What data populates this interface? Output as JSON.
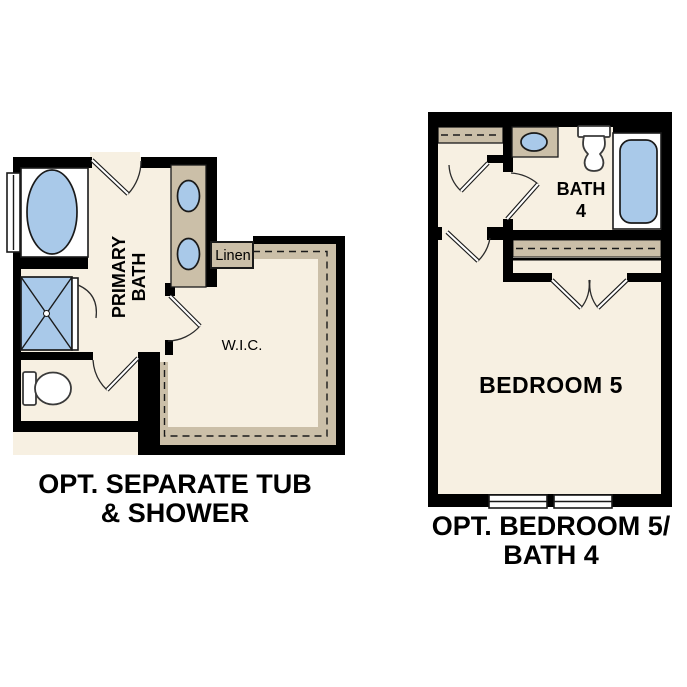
{
  "colors": {
    "floor": "#f7f0e2",
    "cabinet_tan": "#cbbfa8",
    "fixture_blue": "#a9c9e9",
    "wall": "#000000",
    "text": "#000000"
  },
  "left_plan": {
    "labels": {
      "primary_bath_line1": "PRIMARY",
      "primary_bath_line2": "BATH",
      "wic": "W.I.C.",
      "linen": "Linen"
    },
    "caption_line1": "OPT. SEPARATE TUB",
    "caption_line2": "& SHOWER"
  },
  "right_plan": {
    "labels": {
      "bath_line1": "BATH",
      "bath_line2": "4",
      "bedroom": "BEDROOM 5"
    },
    "caption_line1": "OPT. BEDROOM 5/",
    "caption_line2": "BATH 4"
  }
}
